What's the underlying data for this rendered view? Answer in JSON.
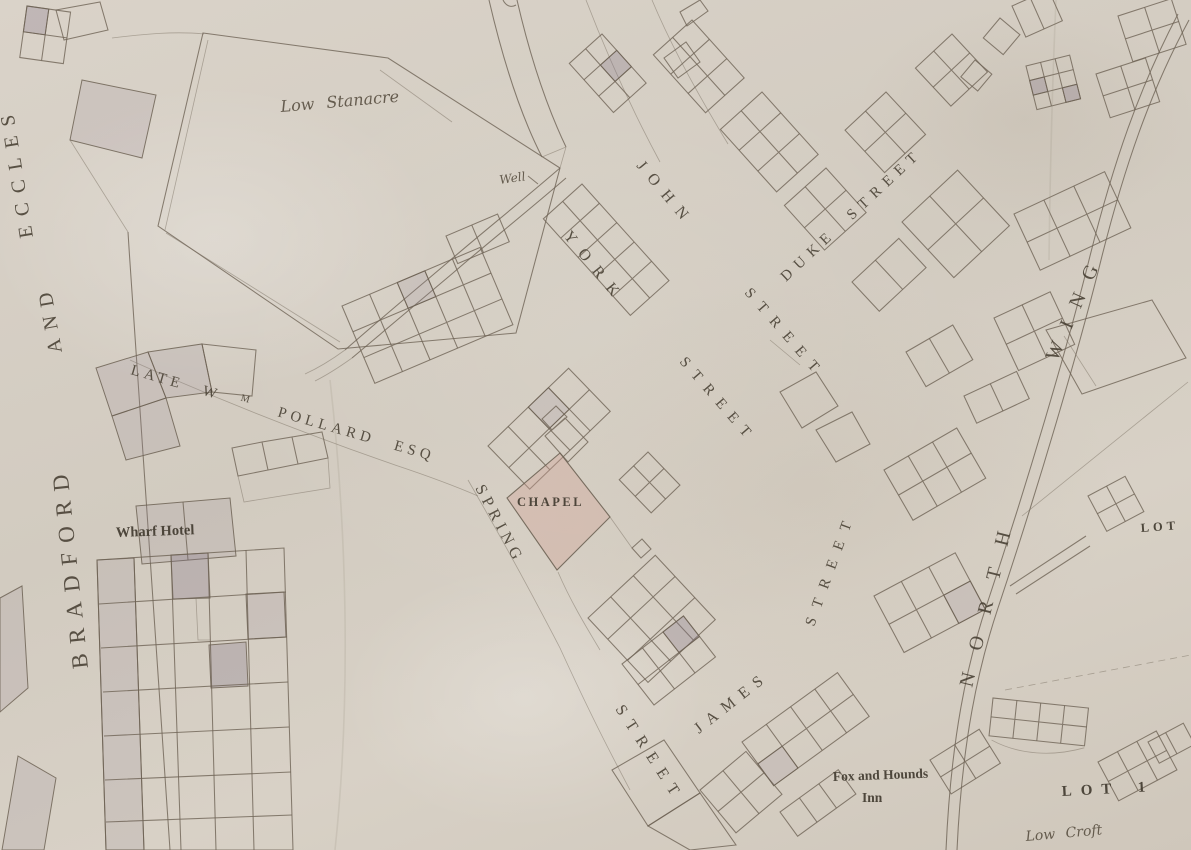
{
  "colors": {
    "paper": "#d7d0c6",
    "ink": "#6e6355",
    "parcel_shade": "#968a98",
    "chapel_wash": "#d0a296",
    "lettering": "#453d31"
  },
  "streets": {
    "bradford": "BRADFORD",
    "and": "AND",
    "eccles": "ECCLES",
    "york": "YORK",
    "york_street": "STREET",
    "john": "JOHN",
    "john_street": "STREET",
    "duke": "DUKE STREET",
    "spring": "SPRING",
    "spring_street": "STREET",
    "james": "JAMES",
    "james_street": "STREET",
    "north": "NORTH",
    "wing": "WING"
  },
  "labels": {
    "low_stanacre": "Low Stanacre",
    "well": "Well",
    "late_w": "LATE W",
    "m_sup": "M",
    "pollard_esq": "POLLARD ESQ",
    "wharf_hotel": "Wharf Hotel",
    "chapel": "CHAPEL",
    "fox_and_hounds": "Fox and Hounds",
    "inn": "Inn",
    "lot_1": "LOT 1",
    "lot": "LOT",
    "low_croft": "Low Croft"
  }
}
